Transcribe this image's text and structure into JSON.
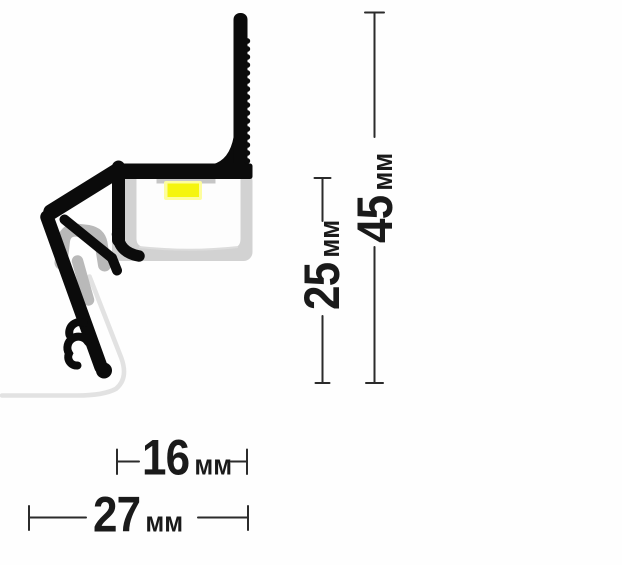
{
  "diagram": {
    "dimensions": {
      "total_height": {
        "value": "45",
        "unit": "мм"
      },
      "front_height": {
        "value": "25",
        "unit": "мм"
      },
      "inner_width": {
        "value": "16",
        "unit": "мм"
      },
      "total_width": {
        "value": "27",
        "unit": "мм"
      }
    },
    "colors": {
      "profile_body": "#0b0b0b",
      "diffuser_frame": "#d2d2d2",
      "diffuser_inner": "#fdfdfd",
      "diffuser_inner_arc": "#dcdcdc",
      "pcb_strip": "#c6c6c6",
      "led_glow": "#fdfd9e",
      "led_core": "#f5f50e",
      "gasket": "#b9b9b9",
      "wall_floor_outline": "#e2e2e2",
      "dimension_line": "#2b2b2b",
      "dimension_text": "#1a1a1a"
    }
  }
}
